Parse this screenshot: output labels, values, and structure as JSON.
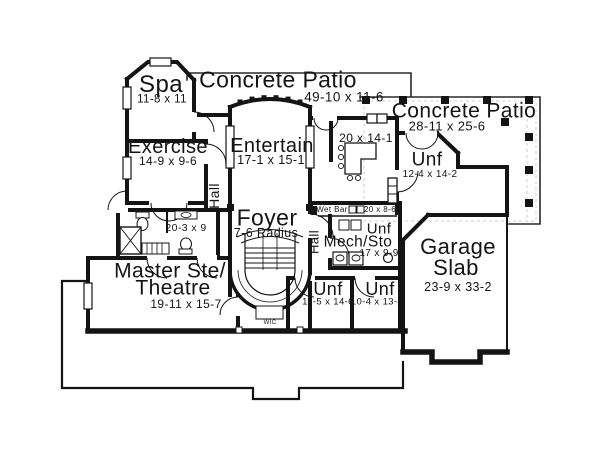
{
  "rooms": {
    "spa": {
      "label": "Spa",
      "dims": "11-8 x 11"
    },
    "patio_top": {
      "label": "Concrete Patio",
      "dims": "49-10 x 11-6"
    },
    "patio_right": {
      "label": "Concrete Patio",
      "dims": "28-11 x 25-6"
    },
    "exercise": {
      "label": "Exercise",
      "dims": "14-9 x 9-6"
    },
    "entertain": {
      "label": "Entertain",
      "dims": "17-1 x 15-1"
    },
    "bar_room": {
      "dims": "20 x 14-1"
    },
    "unf_upper": {
      "label": "Unf",
      "dims": "12-4 x 14-2"
    },
    "hall_left": {
      "label": "Hall"
    },
    "hall_right": {
      "label": "Hall"
    },
    "foyer": {
      "label": "Foyer",
      "dims": "7-6 Radius"
    },
    "wet_bar": {
      "label": "Wet Bar",
      "dims": "20 x 8-6"
    },
    "unf_mech": {
      "label": "Unf"
    },
    "mech_sto": {
      "label": "Mech/Sto",
      "dims": "17 x 9-9"
    },
    "garage": {
      "label_line1": "Garage",
      "label_line2": "Slab",
      "dims": "23-9 x 33-2"
    },
    "master_bath": {
      "dims": "20-3 x 9"
    },
    "master": {
      "label_line1": "Master Ste/",
      "label_line2": "Theatre",
      "dims": "19-11 x 15-7"
    },
    "unf_left": {
      "label": "Unf",
      "dims": "11-5 x 14-6"
    },
    "unf_right": {
      "label": "Unf",
      "dims": "10-4 x 13-4"
    },
    "wic": {
      "label": "WIC"
    }
  },
  "colors": {
    "wall": "#141414",
    "light_line": "#c9c9c9",
    "background": "#ffffff",
    "text": "#141414"
  }
}
